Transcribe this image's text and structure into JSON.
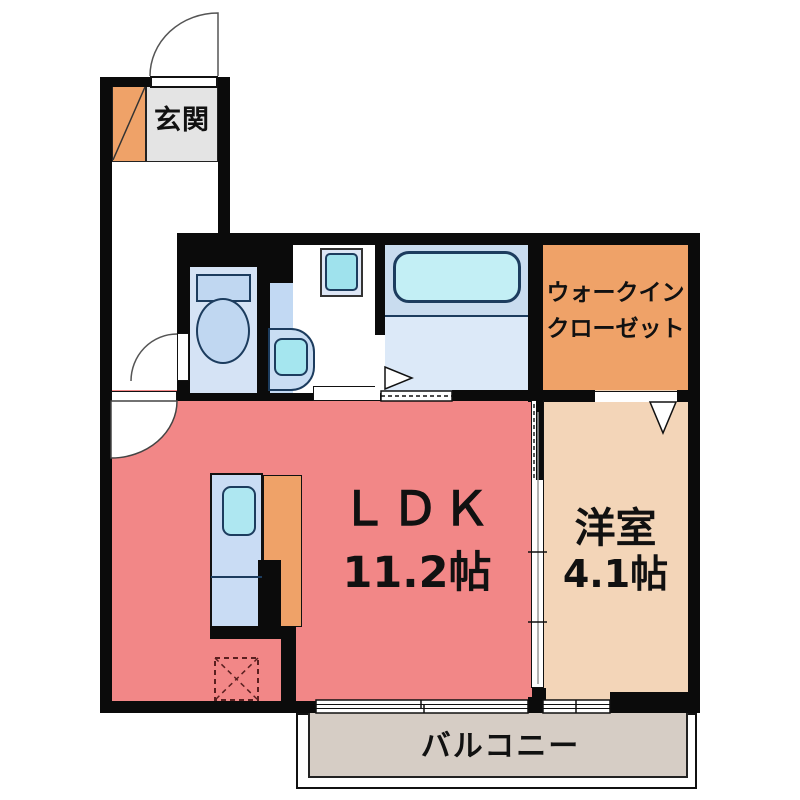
{
  "rooms": {
    "genkan": {
      "label": "玄関"
    },
    "walk_in_closet": {
      "label_line1": "ウォークイン",
      "label_line2": "クローゼット"
    },
    "ldk": {
      "label": "ＬＤＫ",
      "size": "11.2帖"
    },
    "western_room": {
      "label": "洋室",
      "size": "4.1帖"
    },
    "balcony": {
      "label": "バルコニー"
    }
  },
  "fixtures": {
    "entrance_door": "hinged-door-arc",
    "shoe_cabinet": "orange-box-with-diagonal",
    "toilet": "tank-and-bowl",
    "washbasin": "vanity-with-bowl",
    "washing_machine": "square-with-teal-tub",
    "bathtub": "rounded-tub",
    "kitchen_counter": "counter-with-sink",
    "refrigerator_space": "dashed-box-with-x",
    "windows": "double-line-sliding-windows"
  },
  "colors": {
    "wall": "#0b0b0b",
    "ldk_floor": "#F28787",
    "western_room_floor": "#F3D5B8",
    "closet_orange": "#EFA268",
    "genkan_floor": "#E4E4E4",
    "balcony_floor": "#D6CDC5",
    "bath_floor": "#DCE9F8",
    "bath_upper": "#C9DCEF",
    "fixture_blue": "#C0D7F1",
    "water_teal": "#A5E6EF",
    "tub_cyan": "#C3EFF5"
  }
}
